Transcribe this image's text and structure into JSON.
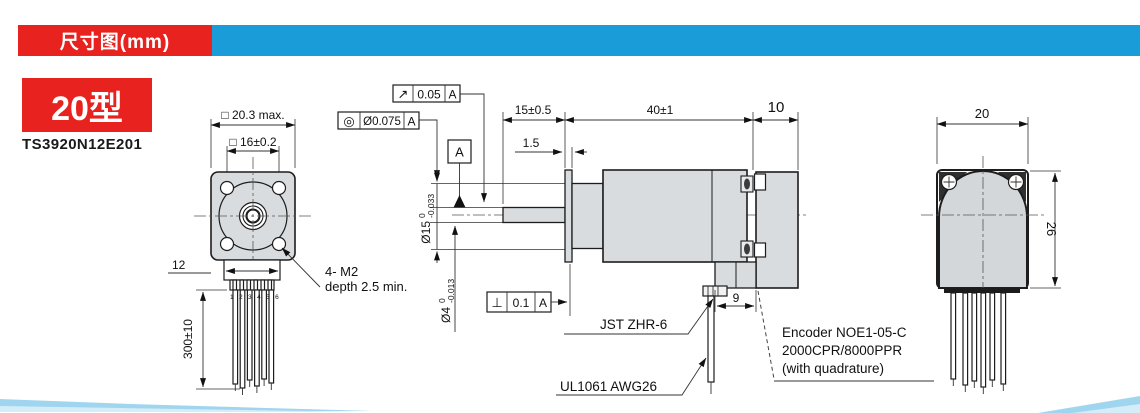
{
  "header": {
    "title": "尺寸图(mm)"
  },
  "product": {
    "type_label": "20型",
    "model": "TS3920N12E201"
  },
  "colors": {
    "accent_red": "#e8231f",
    "accent_blue": "#1a9cd8",
    "body_gray": "#d9dcde",
    "wedge_blue": "#9fd5ee"
  },
  "front_view": {
    "dim_outline": "□ 20.3 max.",
    "dim_mounting": "□ 16±0.2",
    "dim_connector_width": "12",
    "dim_lead_length": "300±10",
    "pin_numbers": "1 2 3 4 5 6",
    "screw_note_line1": "4- M2",
    "screw_note_line2": "depth 2.5 min."
  },
  "gdt": {
    "runout": {
      "symbol": "↗",
      "tolerance": "0.05",
      "datum": "A"
    },
    "concentricity": {
      "symbol": "◎",
      "tolerance": "Ø0.075",
      "datum": "A"
    },
    "perpendicularity": {
      "symbol": "⊥",
      "tolerance": "0.1",
      "datum": "A"
    },
    "datum_flag": "A"
  },
  "side_view": {
    "dim_shaft_length": "15±0.5",
    "dim_body_length": "40±1",
    "dim_encoder_length": "10",
    "dim_flange_thickness": "1.5",
    "dim_connector": "9",
    "pilot_diameter": {
      "main": "Ø15",
      "tol_upper": "0",
      "tol_lower": "-0.033"
    },
    "shaft_diameter": {
      "main": "Ø4",
      "tol_upper": "0",
      "tol_lower": "-0.013"
    },
    "connector_label": "JST ZHR-6",
    "lead_wire_label": "UL1061 AWG26",
    "encoder_note_line1": "Encoder NOE1-05-C",
    "encoder_note_line2": "2000CPR/8000PPR",
    "encoder_note_line3": "(with quadrature)"
  },
  "rear_view": {
    "dim_width": "20",
    "dim_height": "26"
  }
}
